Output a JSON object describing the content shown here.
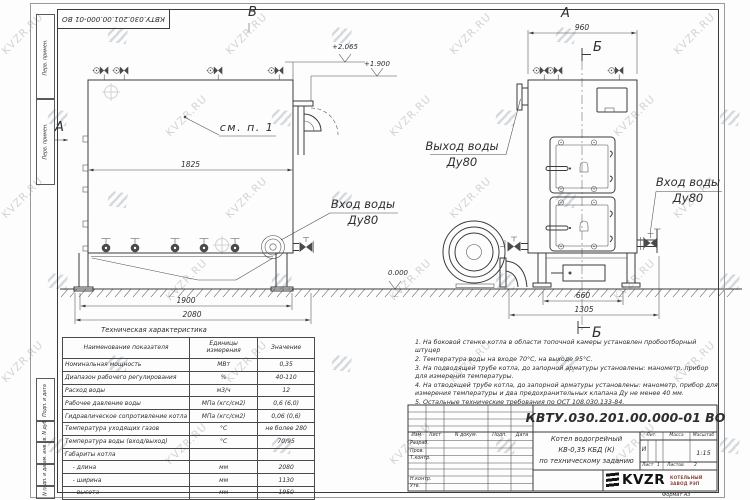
{
  "watermark": {
    "text": "KVZR.RU"
  },
  "frame": {
    "stamp_top": "КВТУ.030.201.00.000-01 ВО",
    "format_note": "Формат  А3",
    "margin_labels": [
      "Перв. примен.",
      "Перв. примен.",
      "Подп. и дата",
      "Инв. N дубл.",
      "Взам. инв. N",
      "Подп. и дата",
      "Инв. N подл."
    ]
  },
  "side_view": {
    "view_arrow": "А",
    "view_mark_top": "В",
    "callout": "см. п. 1",
    "dims": {
      "width_inner": "1825",
      "width_base": "1900",
      "width_total": "2080"
    },
    "elevations": {
      "top": "+2.065",
      "pipe": "+1.900",
      "ground": "0.000"
    },
    "inlet": {
      "line1": "Вход воды",
      "line2": "Ду80"
    }
  },
  "front_view": {
    "view_label": "А",
    "section_mark": "Б",
    "dims": {
      "width_top": "960",
      "base": "660",
      "overall": "1305"
    },
    "outlet": {
      "line1": "Выход воды",
      "line2": "Ду80"
    },
    "inlet": {
      "line1": "Вход воды",
      "line2": "Ду80"
    }
  },
  "spec_table": {
    "title": "Техническая характеристика",
    "headers": [
      "Наименование показателя",
      "Единицы измерения",
      "Значение"
    ],
    "rows": [
      [
        "Номинальная мощность",
        "МВт",
        "0,35"
      ],
      [
        "Диапазон рабочего регулирования",
        "%",
        "40-110"
      ],
      [
        "Расход воды",
        "м3/ч",
        "12"
      ],
      [
        "Рабочее давление воды",
        "МПа (кгс/см2)",
        "0,6 (6,0)"
      ],
      [
        "Гидравлическое сопротивление котла",
        "МПа (кгс/см2)",
        "0,06 (0,6)"
      ],
      [
        "Температура уходящих газов",
        "°С",
        "не более 280"
      ],
      [
        "Температура воды (вход/выход)",
        "°С",
        "70/95"
      ],
      [
        "Габариты котла",
        "",
        ""
      ],
      [
        "    - длина",
        "мм",
        "2080"
      ],
      [
        "    - ширина",
        "мм",
        "1130"
      ],
      [
        "    - высота",
        "мм",
        "1950"
      ]
    ]
  },
  "notes": [
    "1.  На боковой стенке котла в области топочной камеры установлен пробоотборный штуцер",
    "2.  Температура воды на входе 70°С, на выходе 95°С.",
    "3.  На подводящей трубе котла, до запорной арматуры установлены: манометр, прибор для измерения температуры.",
    "4.  На отводящей трубе котла, до запорной арматуры установлены: манометр, прибор для измерения температуры и два предохранительных клапана Ду не менее 40 мм.",
    "5.  Остальные технические требования по ОСТ 108.030.133-84."
  ],
  "title_block": {
    "doc_number": "КВТУ.030.201.00.000-01 ВО",
    "columns": [
      "Изм.",
      "Лист",
      "N докум.",
      "Подп.",
      "Дата"
    ],
    "rows": [
      "Разраб.",
      "Пров.",
      "Т.контр.",
      "Н.контр.",
      "Утв."
    ],
    "product": [
      "Котел водогрейный",
      "КВ-0,35 КБД (К)",
      "по техническому заданию"
    ],
    "lit_label": "Лит.",
    "lit_value": "И",
    "mass_label": "Масса",
    "scale_label": "Масштаб",
    "scale_value": "1:15",
    "sheet_label": "Лист",
    "sheet_value": "1",
    "sheets_label": "Листов",
    "sheets_value": "2",
    "brand": "KVZR",
    "brand_line1": "КОТЕЛЬНЫЙ",
    "brand_line2": "ЗАВОД РЭП"
  }
}
